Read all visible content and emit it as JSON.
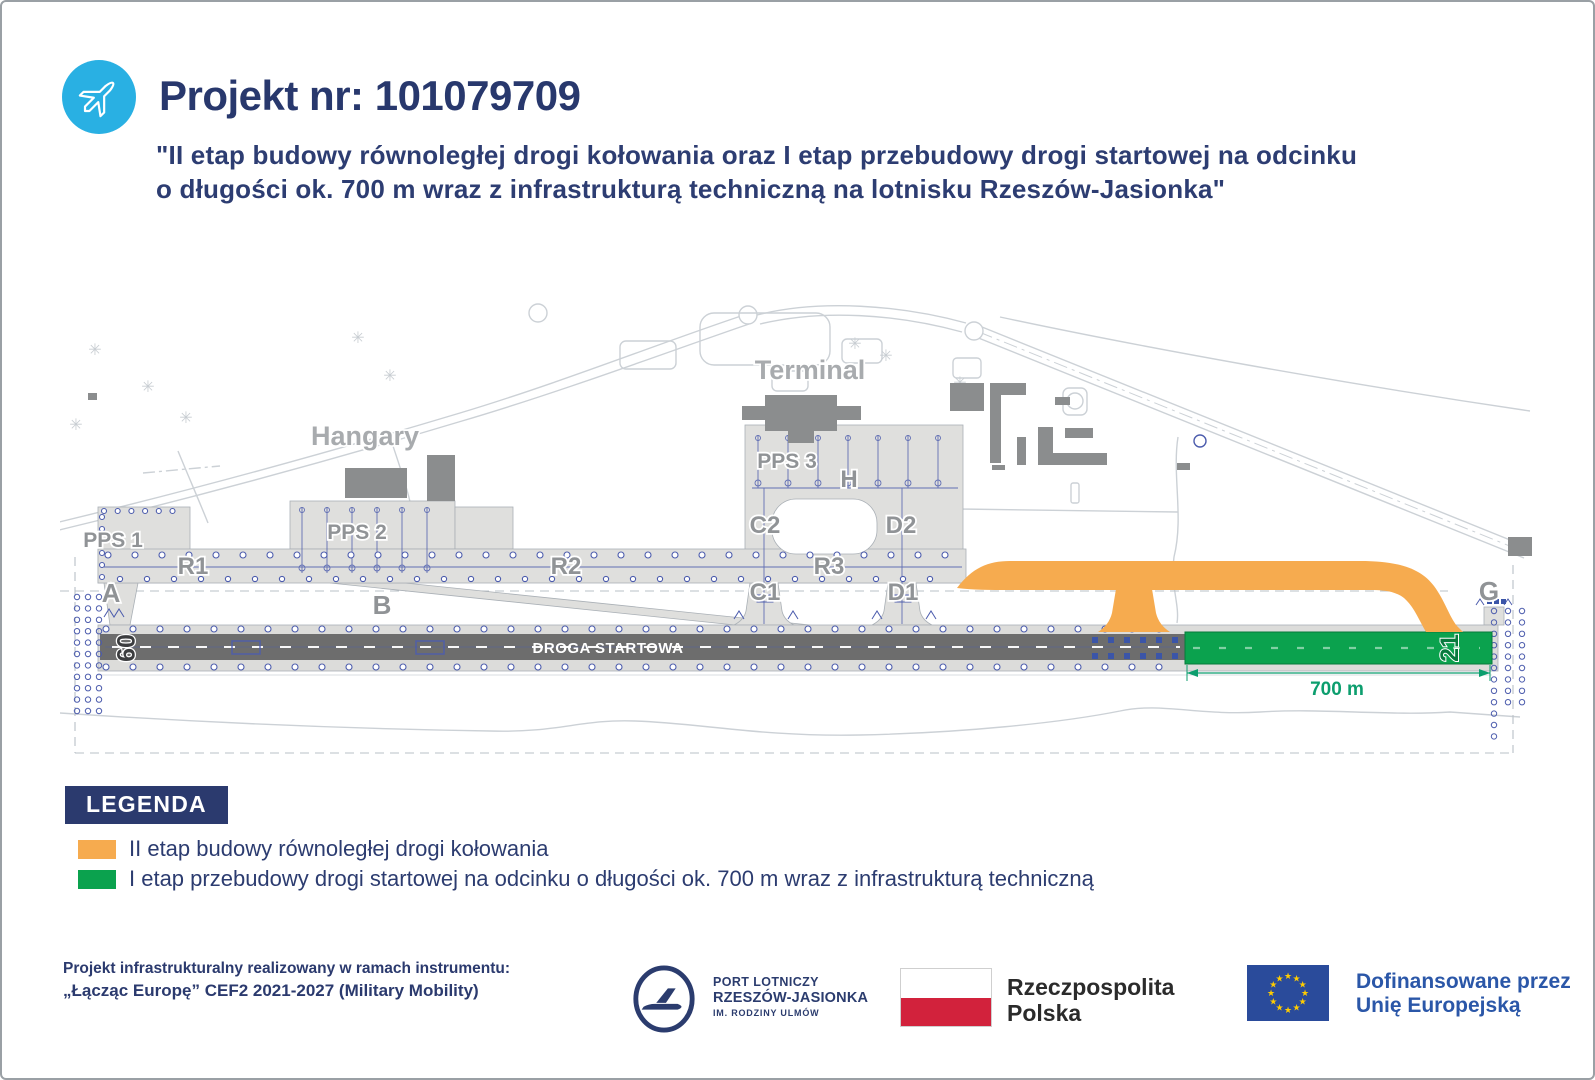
{
  "header": {
    "title": "Projekt nr: 101079709",
    "subtitle_line1": "\"II etap budowy równoległej drogi kołowania oraz I etap przebudowy drogi startowej na odcinku",
    "subtitle_line2": "o długości ok. 700 m wraz z infrastrukturą techniczną na lotnisku Rzeszów-Jasionka\""
  },
  "map": {
    "labels": {
      "terminal": "Terminal",
      "hangary": "Hangary",
      "pps1": "PPS 1",
      "pps2": "PPS 2",
      "pps3": "PPS 3",
      "r1": "R1",
      "r2": "R2",
      "r3": "R3",
      "a": "A",
      "b": "B",
      "c1": "C1",
      "c2": "C2",
      "d1": "D1",
      "d2": "D2",
      "g": "G",
      "h": "H",
      "runway_name": "DROGA STARTOWA",
      "threshold_left": "09",
      "threshold_right": "21",
      "dimension": "700 m"
    },
    "colors": {
      "new_taxiway_orange": "#f6ab4f",
      "new_runway_green": "#0ba24e",
      "runway_gray": "#6d6d6d",
      "apron_gray": "#dfdfdd",
      "dimension_teal": "#0c9e6e",
      "lights_blue": "#4c5cad"
    }
  },
  "legend": {
    "title": "LEGENDA",
    "items": [
      {
        "color": "#f6ab4f",
        "label": "II etap budowy równoległej drogi kołowania"
      },
      {
        "color": "#0ba24e",
        "label": "I etap przebudowy drogi startowej na odcinku o długości ok. 700 m wraz z infrastrukturą techniczną"
      }
    ]
  },
  "footer": {
    "program_line1": "Projekt infrastrukturalny realizowany w ramach instrumentu:",
    "program_line2": "„Łącząc Europę” CEF2 2021-2027 (Military Mobility)",
    "airport": {
      "line1": "PORT LOTNICZY",
      "line2": "RZESZÓW-JASIONKA",
      "line3": "IM. RODZINY ULMÓW"
    },
    "poland": {
      "line1": "Rzeczpospolita",
      "line2": "Polska"
    },
    "eu": {
      "line1": "Dofinansowane przez",
      "line2": "Unię Europejską"
    }
  }
}
